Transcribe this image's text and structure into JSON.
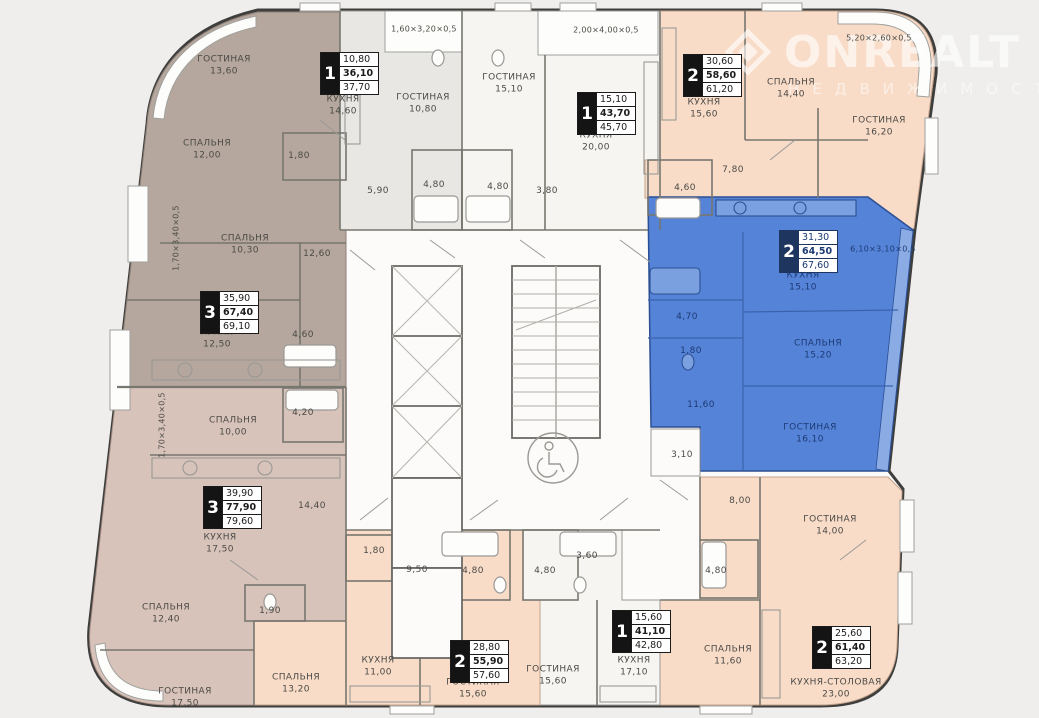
{
  "watermark": {
    "brand": "ONREALT",
    "sub": "НЕДВИЖИМОСТЬ"
  },
  "palette": {
    "taupe": "#b5a79d",
    "gray": "#e8e7e3",
    "white_apt": "#f6f5f1",
    "peach": "#f8dcc8",
    "pink": "#d8c3ba",
    "blue": "#5583d8",
    "blue_text": "#1d3a74",
    "wall": "#3e3e3c"
  },
  "apartment_boxes": [
    {
      "rooms": "1",
      "values": [
        "10,80",
        "36,10",
        "37,70"
      ],
      "x": 320,
      "y": 52,
      "theme": "dark"
    },
    {
      "rooms": "1",
      "values": [
        "15,10",
        "43,70",
        "45,70"
      ],
      "x": 577,
      "y": 92,
      "theme": "dark"
    },
    {
      "rooms": "2",
      "values": [
        "30,60",
        "58,60",
        "61,20"
      ],
      "x": 683,
      "y": 54,
      "theme": "dark"
    },
    {
      "rooms": "2",
      "values": [
        "31,30",
        "64,50",
        "67,60"
      ],
      "x": 779,
      "y": 230,
      "theme": "blue"
    },
    {
      "rooms": "3",
      "values": [
        "35,90",
        "67,40",
        "69,10"
      ],
      "x": 200,
      "y": 291,
      "theme": "dark"
    },
    {
      "rooms": "3",
      "values": [
        "39,90",
        "77,90",
        "79,60"
      ],
      "x": 203,
      "y": 486,
      "theme": "dark"
    },
    {
      "rooms": "2",
      "values": [
        "28,80",
        "55,90",
        "57,60"
      ],
      "x": 450,
      "y": 640,
      "theme": "dark"
    },
    {
      "rooms": "1",
      "values": [
        "15,60",
        "41,10",
        "42,80"
      ],
      "x": 612,
      "y": 610,
      "theme": "dark"
    },
    {
      "rooms": "2",
      "values": [
        "25,60",
        "61,40",
        "63,20"
      ],
      "x": 812,
      "y": 626,
      "theme": "dark"
    }
  ],
  "room_labels": [
    {
      "name": "ГОСТИНАЯ",
      "area": "13,60",
      "x": 224,
      "y": 66,
      "color": "dark"
    },
    {
      "name": "СПАЛЬНЯ",
      "area": "12,00",
      "x": 207,
      "y": 150,
      "color": "dark"
    },
    {
      "name": "СПАЛЬНЯ",
      "area": "10,30",
      "x": 245,
      "y": 245,
      "color": "dark"
    },
    {
      "name": "КУХНЯ",
      "area": "12,50",
      "x": 217,
      "y": 339,
      "color": "dark"
    },
    {
      "name": "КУХНЯ",
      "area": "14,60",
      "x": 343,
      "y": 106,
      "color": "dark"
    },
    {
      "name": "ГОСТИНАЯ",
      "area": "10,80",
      "x": 423,
      "y": 104,
      "color": "dark"
    },
    {
      "name": "ГОСТИНАЯ",
      "area": "15,10",
      "x": 509,
      "y": 84,
      "color": "dark"
    },
    {
      "name": "КУХНЯ",
      "area": "20,00",
      "x": 596,
      "y": 142,
      "color": "dark"
    },
    {
      "name": "КУХНЯ",
      "area": "15,60",
      "x": 704,
      "y": 109,
      "color": "dark"
    },
    {
      "name": "СПАЛЬНЯ",
      "area": "14,40",
      "x": 791,
      "y": 89,
      "color": "dark"
    },
    {
      "name": "ГОСТИНАЯ",
      "area": "16,20",
      "x": 879,
      "y": 127,
      "color": "dark"
    },
    {
      "name": "КУХНЯ",
      "area": "15,10",
      "x": 803,
      "y": 282,
      "color": "blue"
    },
    {
      "name": "СПАЛЬНЯ",
      "area": "15,20",
      "x": 818,
      "y": 350,
      "color": "blue"
    },
    {
      "name": "ГОСТИНАЯ",
      "area": "16,10",
      "x": 810,
      "y": 434,
      "color": "blue"
    },
    {
      "name": "СПАЛЬНЯ",
      "area": "10,00",
      "x": 233,
      "y": 427,
      "color": "dark"
    },
    {
      "name": "КУХНЯ",
      "area": "17,50",
      "x": 220,
      "y": 544,
      "color": "dark"
    },
    {
      "name": "СПАЛЬНЯ",
      "area": "12,40",
      "x": 166,
      "y": 614,
      "color": "dark"
    },
    {
      "name": "ГОСТИНАЯ",
      "area": "17,50",
      "x": 185,
      "y": 698,
      "color": "dark"
    },
    {
      "name": "СПАЛЬНЯ",
      "area": "13,20",
      "x": 296,
      "y": 684,
      "color": "dark"
    },
    {
      "name": "КУХНЯ",
      "area": "11,00",
      "x": 378,
      "y": 667,
      "color": "dark"
    },
    {
      "name": "ГОСТИНАЯ",
      "area": "15,60",
      "x": 473,
      "y": 689,
      "color": "dark"
    },
    {
      "name": "ГОСТИНАЯ",
      "area": "15,60",
      "x": 553,
      "y": 676,
      "color": "dark"
    },
    {
      "name": "КУХНЯ",
      "area": "17,10",
      "x": 634,
      "y": 667,
      "color": "dark"
    },
    {
      "name": "ГОСТИНАЯ",
      "area": "14,00",
      "x": 830,
      "y": 526,
      "color": "dark"
    },
    {
      "name": "СПАЛЬНЯ",
      "area": "11,60",
      "x": 728,
      "y": 656,
      "color": "dark"
    },
    {
      "name": "КУХНЯ-СТОЛОВАЯ",
      "area": "23,00",
      "x": 836,
      "y": 689,
      "color": "dark"
    }
  ],
  "area_labels": [
    {
      "value": "1,80",
      "x": 299,
      "y": 157,
      "color": "dark"
    },
    {
      "value": "12,60",
      "x": 317,
      "y": 255,
      "color": "dark"
    },
    {
      "value": "4,60",
      "x": 303,
      "y": 336,
      "color": "dark"
    },
    {
      "value": "5,90",
      "x": 378,
      "y": 192,
      "color": "dark"
    },
    {
      "value": "4,80",
      "x": 434,
      "y": 186,
      "color": "dark"
    },
    {
      "value": "4,80",
      "x": 498,
      "y": 188,
      "color": "dark"
    },
    {
      "value": "3,80",
      "x": 547,
      "y": 192,
      "color": "dark"
    },
    {
      "value": "7,80",
      "x": 733,
      "y": 171,
      "color": "dark"
    },
    {
      "value": "4,60",
      "x": 685,
      "y": 189,
      "color": "dark"
    },
    {
      "value": "4,70",
      "x": 687,
      "y": 318,
      "color": "blue"
    },
    {
      "value": "1,80",
      "x": 691,
      "y": 352,
      "color": "blue"
    },
    {
      "value": "11,60",
      "x": 701,
      "y": 406,
      "color": "blue"
    },
    {
      "value": "3,10",
      "x": 682,
      "y": 456,
      "color": "dark"
    },
    {
      "value": "4,20",
      "x": 303,
      "y": 414,
      "color": "dark"
    },
    {
      "value": "14,40",
      "x": 312,
      "y": 507,
      "color": "dark"
    },
    {
      "value": "1,90",
      "x": 270,
      "y": 612,
      "color": "dark"
    },
    {
      "value": "1,80",
      "x": 374,
      "y": 552,
      "color": "dark"
    },
    {
      "value": "9,50",
      "x": 417,
      "y": 571,
      "color": "dark"
    },
    {
      "value": "4,80",
      "x": 473,
      "y": 572,
      "color": "dark"
    },
    {
      "value": "4,80",
      "x": 545,
      "y": 572,
      "color": "dark"
    },
    {
      "value": "3,60",
      "x": 587,
      "y": 557,
      "color": "dark"
    },
    {
      "value": "8,00",
      "x": 740,
      "y": 502,
      "color": "dark"
    },
    {
      "value": "4,80",
      "x": 716,
      "y": 572,
      "color": "dark"
    }
  ],
  "dim_labels": [
    {
      "value": "1,60×3,20×0,5",
      "x": 424,
      "y": 29,
      "vertical": false,
      "color": "dark"
    },
    {
      "value": "2,00×4,00×0,5",
      "x": 606,
      "y": 30,
      "vertical": false,
      "color": "dark"
    },
    {
      "value": "5,20×2,60×0,5",
      "x": 879,
      "y": 38,
      "vertical": false,
      "color": "dark"
    },
    {
      "value": "6,10×3,10×0,5",
      "x": 883,
      "y": 249,
      "vertical": false,
      "color": "blue"
    },
    {
      "value": "1,70×3,40×0,5",
      "x": 176,
      "y": 238,
      "vertical": true,
      "color": "dark"
    },
    {
      "value": "1,70×3,40×0,5",
      "x": 162,
      "y": 425,
      "vertical": true,
      "color": "dark"
    }
  ]
}
